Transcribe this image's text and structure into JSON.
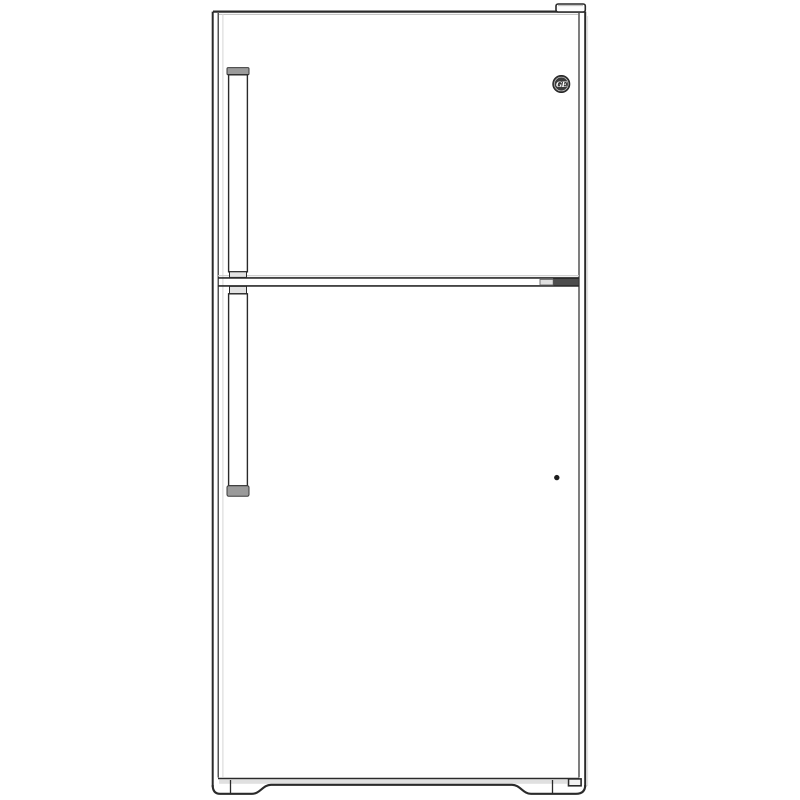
{
  "image": {
    "subject": "Top-freezer refrigerator, front view line drawing",
    "brand_logo": "GE"
  },
  "colors": {
    "background": "#ffffff",
    "line": "#2a2a2a",
    "line_soft": "#5a5a5a",
    "shadow": "#c6c6c6",
    "shadow_light": "#dedede",
    "handle_cap": "#9b9b9b",
    "mount_light": "#e3e3e3",
    "hinge_dark": "#4d4d4d",
    "logo_bg": "#3a3a3a",
    "logo_fg": "#ffffff"
  }
}
